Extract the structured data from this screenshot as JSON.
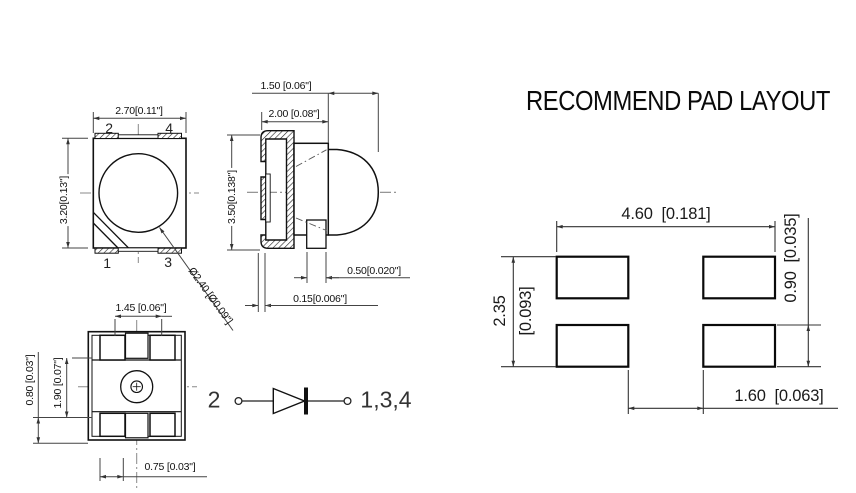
{
  "title": "RECOMMEND PAD LAYOUT",
  "front_view": {
    "dim_width": "2.70[0.11\"]",
    "dim_height": "3.20[0.13\"]",
    "dim_lens_diameter": "Ø2.40 [Ø0.09\"]",
    "pins": {
      "top_left": "2",
      "top_right": "4",
      "bottom_left": "1",
      "bottom_right": "3"
    }
  },
  "side_view": {
    "dim_lens_depth": "1.50 [0.06\"]",
    "dim_body_depth": "2.00 [0.08\"]",
    "dim_height": "3.50[0.138\"]",
    "dim_lead_width": "0.50[0.020\"]",
    "dim_lead_standoff": "0.15[0.006\"]"
  },
  "bottom_view": {
    "dim_tab_width": "1.45 [0.06\"]",
    "dim_pad_row": "0.80 [0.03\"]",
    "dim_body_mid": "1.90 [0.07\"]",
    "dim_tab_offset": "0.75 [0.03\"]"
  },
  "circuit": {
    "anode_pin": "2",
    "cathode_pins": "1,3,4"
  },
  "pad_layout": {
    "dim_overall_width": "4.60  [0.181]",
    "dim_overall_height_mm": "2.35",
    "dim_overall_height_in": "[0.093]",
    "dim_pad_height": "0.90  [0.035]",
    "dim_pad_gap": "1.60  [0.063]"
  },
  "colors": {
    "ink": "#111111",
    "dim_line": "#444444",
    "centerline": "#888888",
    "background": "#ffffff"
  }
}
